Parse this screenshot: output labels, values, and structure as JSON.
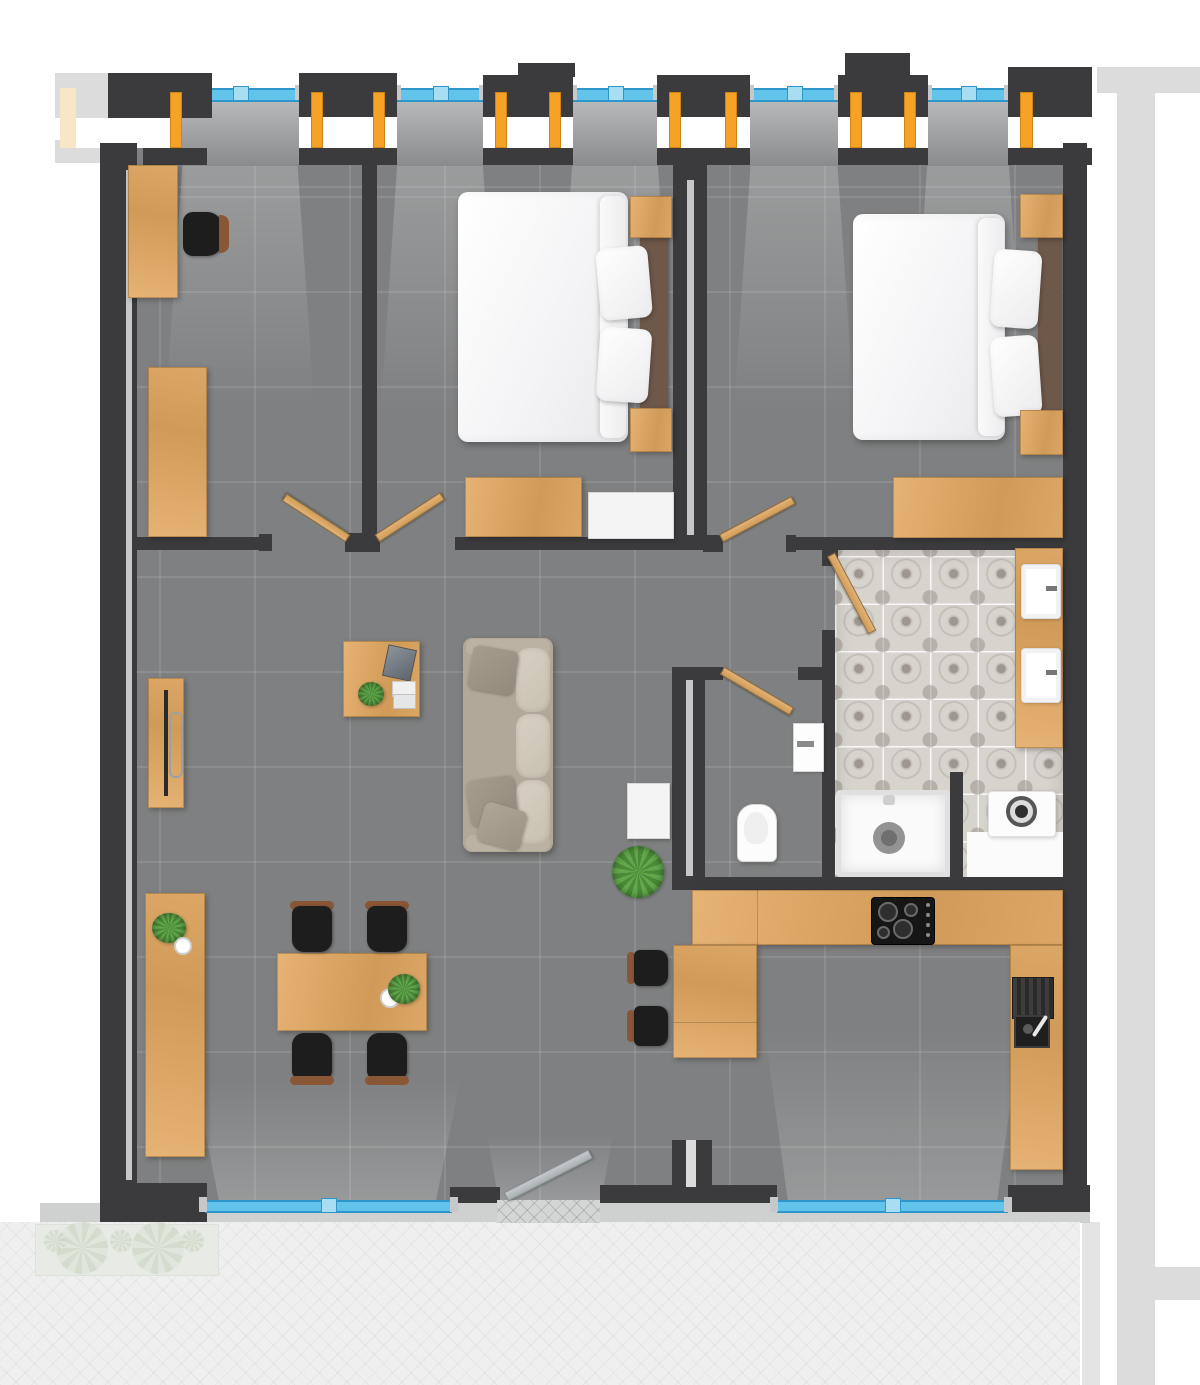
{
  "palette": {
    "wall": "#3b3b3d",
    "wall_core": "#c7c7c8",
    "floor": "#7f8081",
    "wood1": "#dca766",
    "wood2": "#e6b376",
    "wood3": "#d09a58",
    "orange": "#f5a226",
    "window_blue": "#62c4ea",
    "window_blue_dark": "#2e96c8",
    "window_blue_lt": "#a8ddf2",
    "ext_gray": "#dcdcdc",
    "ext_gray2": "#e4e4e4",
    "terrace": "#efefef",
    "beige": "#f7e7c6",
    "tile_base": "#d7d3cd",
    "sofa": "#b2a899",
    "chair_brown": "#8a5736",
    "plant1": "#4a8a38",
    "plant2": "#62a84b"
  },
  "scene": {
    "type": "apartment-floor-plan-top-view",
    "rooms": [
      {
        "name": "office",
        "furniture": [
          "desk",
          "office-chair",
          "bookcase"
        ]
      },
      {
        "name": "bedroom-1",
        "furniture": [
          "double-bed",
          "pillows",
          "nightstand",
          "nightstand",
          "dresser",
          "white-cabinet"
        ]
      },
      {
        "name": "bedroom-2",
        "furniture": [
          "double-bed",
          "pillows",
          "nightstand",
          "nightstand",
          "dresser"
        ]
      },
      {
        "name": "living-dining",
        "furniture": [
          "sofa",
          "coffee-table",
          "laptop",
          "books",
          "table-plant",
          "floor-plant",
          "shoe-cabinet",
          "wall-bench",
          "dining-table",
          "dining-chair",
          "dining-chair",
          "dining-chair",
          "dining-chair",
          "sideboard"
        ]
      },
      {
        "name": "kitchen",
        "furniture": [
          "u-shaped-counter",
          "cooktop",
          "kitchen-sink",
          "bar-chair",
          "bar-chair"
        ]
      },
      {
        "name": "bathroom",
        "furniture": [
          "vanity",
          "sink",
          "sink",
          "shower",
          "washing-machine"
        ]
      },
      {
        "name": "wc",
        "furniture": [
          "toilet",
          "wall-basin"
        ]
      },
      {
        "name": "corridor",
        "furniture": []
      }
    ],
    "doors": [
      "office-door",
      "bedroom-1-door",
      "bedroom-2-door",
      "bathroom-door",
      "wc-door",
      "entrance-door"
    ],
    "windows": {
      "top_bays": 5,
      "bottom_windows": [
        "dining-window",
        "kitchen-window"
      ]
    },
    "exterior": [
      "terrace-herringbone",
      "planter-with-plants",
      "neighbor-structures"
    ]
  }
}
